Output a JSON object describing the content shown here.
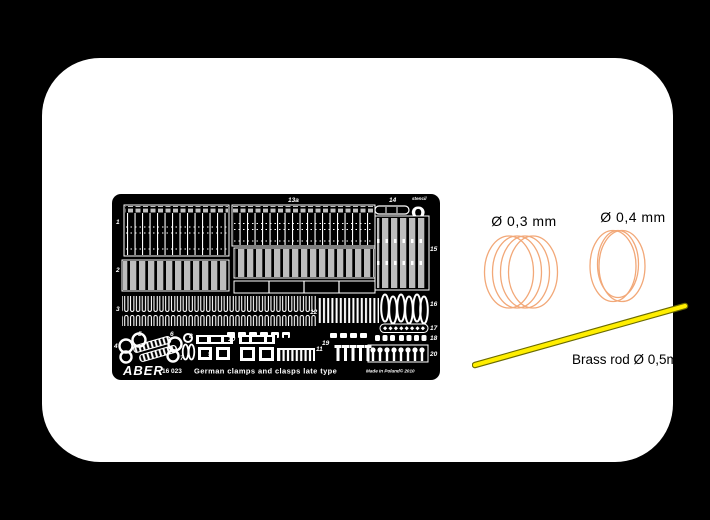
{
  "page": {
    "background_color": "#000000",
    "card_color": "#ffffff"
  },
  "fret": {
    "brand": "ABER",
    "catalog_no": "16 023",
    "plate_title": "German clamps and clasps late type",
    "made_in": "Made in Poland© 2010",
    "stencil_note": "stencil",
    "omega_glyph": "Ω",
    "labels": {
      "p1": "1",
      "p2": "2",
      "p3": "3",
      "p4": "4",
      "p5": "5",
      "p6": "6",
      "p7": "7",
      "p8": "8",
      "p9": "9",
      "p10": "10",
      "p11": "11",
      "p12": "12",
      "p13a": "13a",
      "p14": "14",
      "p15": "15",
      "p16": "16",
      "p17": "17",
      "p18": "18",
      "p19": "19",
      "p20": "20"
    }
  },
  "materials": {
    "coil_small": {
      "label": "Ø 0,3 mm",
      "color": "#f2a878"
    },
    "coil_large": {
      "label": "Ø 0,4 mm",
      "color": "#f2a878"
    },
    "rod": {
      "label": "Brass rod Ø 0,5mm",
      "fill_color": "#ffee00",
      "edge_color": "#6b6b00"
    }
  },
  "caption": {
    "catalog_no": "16 023",
    "title": "German clasps & clamps (2 choice) late type"
  }
}
